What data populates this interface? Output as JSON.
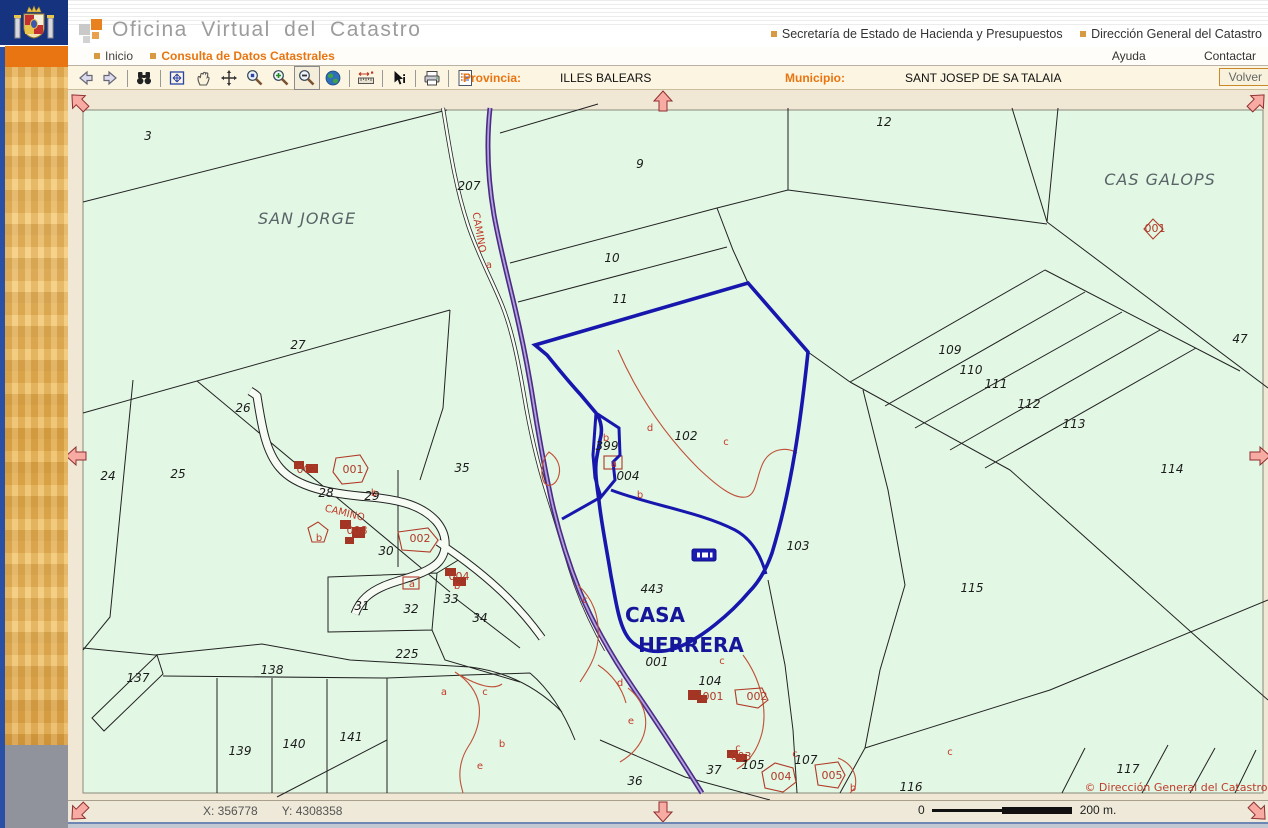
{
  "header": {
    "title": "Oficina Virtual del Catastro",
    "link1": "Secretaría de Estado de Hacienda y Presupuestos",
    "link2": "Dirección General del Catastro"
  },
  "menu": {
    "inicio": "Inicio",
    "consulta": "Consulta de Datos Catastrales",
    "ayuda": "Ayuda",
    "contactar": "Contactar"
  },
  "toolbar": {
    "tools": [
      "back",
      "forward",
      "find",
      "full-extent",
      "pan",
      "move",
      "zoom-rect",
      "zoom-in",
      "zoom-out",
      "world",
      "measure",
      "info",
      "print",
      "report"
    ],
    "active_tool": "zoom-out",
    "provincia_label": "Provincia:",
    "provincia_value": "ILLES BALEARS",
    "municipio_label": "Municipio:",
    "municipio_value": "SANT JOSEP DE SA TALAIA",
    "volver": "Volver"
  },
  "statusbar": {
    "x_coord": "X: 356778",
    "y_coord": "Y: 4308358",
    "scale_zero": "0",
    "scale_end": "200 m."
  },
  "map": {
    "copyright": "© Dirección General del Catastro",
    "colors": {
      "accent_orange": "#E87511",
      "map_green": "#E2F7E4",
      "selection_blue": "#1717AE",
      "building_red": "#B03A28",
      "arrow_pink": "#F7ABA3"
    },
    "labels": [
      {
        "t": "3",
        "x": 148,
        "y": 140,
        "c": "pn"
      },
      {
        "t": "9",
        "x": 640,
        "y": 168,
        "c": "pn"
      },
      {
        "t": "10",
        "x": 612,
        "y": 262,
        "c": "pn"
      },
      {
        "t": "11",
        "x": 620,
        "y": 303,
        "c": "pn"
      },
      {
        "t": "12",
        "x": 884,
        "y": 126,
        "c": "pn"
      },
      {
        "t": "207",
        "x": 469,
        "y": 190,
        "c": "pn"
      },
      {
        "t": "27",
        "x": 298,
        "y": 349,
        "c": "pn"
      },
      {
        "t": "26",
        "x": 243,
        "y": 412,
        "c": "pn"
      },
      {
        "t": "24",
        "x": 108,
        "y": 480,
        "c": "pn"
      },
      {
        "t": "25",
        "x": 178,
        "y": 478,
        "c": "pn"
      },
      {
        "t": "35",
        "x": 462,
        "y": 472,
        "c": "pn"
      },
      {
        "t": "28",
        "x": 326,
        "y": 497,
        "c": "pn"
      },
      {
        "t": "29",
        "x": 372,
        "y": 500,
        "c": "pn"
      },
      {
        "t": "30",
        "x": 386,
        "y": 555,
        "c": "pn"
      },
      {
        "t": "31",
        "x": 362,
        "y": 610,
        "c": "pn"
      },
      {
        "t": "32",
        "x": 411,
        "y": 613,
        "c": "pn"
      },
      {
        "t": "33",
        "x": 451,
        "y": 603,
        "c": "pn"
      },
      {
        "t": "34",
        "x": 480,
        "y": 622,
        "c": "pn"
      },
      {
        "t": "36",
        "x": 635,
        "y": 785,
        "c": "pn"
      },
      {
        "t": "37",
        "x": 714,
        "y": 774,
        "c": "pn"
      },
      {
        "t": "47",
        "x": 1240,
        "y": 343,
        "c": "pn"
      },
      {
        "t": "102",
        "x": 686,
        "y": 440,
        "c": "pn"
      },
      {
        "t": "103",
        "x": 798,
        "y": 550,
        "c": "pn"
      },
      {
        "t": "104",
        "x": 710,
        "y": 685,
        "c": "pn"
      },
      {
        "t": "105",
        "x": 753,
        "y": 769,
        "c": "pn"
      },
      {
        "t": "107",
        "x": 806,
        "y": 764,
        "c": "pn"
      },
      {
        "t": "109",
        "x": 950,
        "y": 354,
        "c": "pn"
      },
      {
        "t": "110",
        "x": 971,
        "y": 374,
        "c": "pn"
      },
      {
        "t": "111",
        "x": 996,
        "y": 388,
        "c": "pn"
      },
      {
        "t": "112",
        "x": 1029,
        "y": 408,
        "c": "pn"
      },
      {
        "t": "113",
        "x": 1074,
        "y": 428,
        "c": "pn"
      },
      {
        "t": "114",
        "x": 1172,
        "y": 473,
        "c": "pn"
      },
      {
        "t": "115",
        "x": 972,
        "y": 592,
        "c": "pn"
      },
      {
        "t": "116",
        "x": 911,
        "y": 791,
        "c": "pn"
      },
      {
        "t": "117",
        "x": 1128,
        "y": 773,
        "c": "pn"
      },
      {
        "t": "137",
        "x": 138,
        "y": 682,
        "c": "pn"
      },
      {
        "t": "138",
        "x": 272,
        "y": 674,
        "c": "pn"
      },
      {
        "t": "139",
        "x": 240,
        "y": 755,
        "c": "pn"
      },
      {
        "t": "140",
        "x": 294,
        "y": 748,
        "c": "pn"
      },
      {
        "t": "141",
        "x": 351,
        "y": 741,
        "c": "pn"
      },
      {
        "t": "225",
        "x": 407,
        "y": 658,
        "c": "pn"
      },
      {
        "t": "443",
        "x": 652,
        "y": 593,
        "c": "pn"
      },
      {
        "t": "399",
        "x": 607,
        "y": 450,
        "c": "pn"
      },
      {
        "t": "004",
        "x": 628,
        "y": 480,
        "c": "pn"
      },
      {
        "t": "001",
        "x": 657,
        "y": 666,
        "c": "pn"
      },
      {
        "t": "SAN JORGE",
        "x": 307,
        "y": 224,
        "c": "place"
      },
      {
        "t": "CAS GALOPS",
        "x": 1160,
        "y": 185,
        "c": "place"
      },
      {
        "t": "CASA",
        "x": 655,
        "y": 622,
        "c": "casa"
      },
      {
        "t": "HERRERA",
        "x": 691,
        "y": 652,
        "c": "casa"
      },
      {
        "t": "CAMINO",
        "x": 476,
        "y": 233,
        "c": "red",
        "r": 80
      },
      {
        "t": "CAMINO",
        "x": 344,
        "y": 516,
        "c": "red",
        "r": 14
      },
      {
        "t": "002",
        "x": 307,
        "y": 473,
        "c": "redb"
      },
      {
        "t": "001",
        "x": 353,
        "y": 473,
        "c": "redb"
      },
      {
        "t": "008",
        "x": 357,
        "y": 534,
        "c": "redb"
      },
      {
        "t": "002",
        "x": 420,
        "y": 542,
        "c": "redb"
      },
      {
        "t": "004",
        "x": 459,
        "y": 580,
        "c": "redb"
      },
      {
        "t": "001",
        "x": 1155,
        "y": 232,
        "c": "redb"
      },
      {
        "t": "001",
        "x": 713,
        "y": 700,
        "c": "redb"
      },
      {
        "t": "002",
        "x": 757,
        "y": 700,
        "c": "redb"
      },
      {
        "t": "003",
        "x": 741,
        "y": 760,
        "c": "redb"
      },
      {
        "t": "004",
        "x": 781,
        "y": 780,
        "c": "redb"
      },
      {
        "t": "005",
        "x": 832,
        "y": 779,
        "c": "redb"
      },
      {
        "t": "a",
        "x": 489,
        "y": 268,
        "c": "red"
      },
      {
        "t": "b",
        "x": 606,
        "y": 441,
        "c": "red"
      },
      {
        "t": "a",
        "x": 614,
        "y": 467,
        "c": "red"
      },
      {
        "t": "b",
        "x": 640,
        "y": 498,
        "c": "red"
      },
      {
        "t": "d",
        "x": 650,
        "y": 431,
        "c": "red"
      },
      {
        "t": "c",
        "x": 726,
        "y": 445,
        "c": "red"
      },
      {
        "t": "c",
        "x": 585,
        "y": 603,
        "c": "red"
      },
      {
        "t": "d",
        "x": 620,
        "y": 686,
        "c": "red"
      },
      {
        "t": "e",
        "x": 631,
        "y": 724,
        "c": "red"
      },
      {
        "t": "c",
        "x": 722,
        "y": 664,
        "c": "red"
      },
      {
        "t": "c",
        "x": 738,
        "y": 751,
        "c": "red"
      },
      {
        "t": "c",
        "x": 795,
        "y": 757,
        "c": "red"
      },
      {
        "t": "c",
        "x": 950,
        "y": 755,
        "c": "red"
      },
      {
        "t": "b",
        "x": 853,
        "y": 791,
        "c": "red"
      },
      {
        "t": "a",
        "x": 444,
        "y": 695,
        "c": "red"
      },
      {
        "t": "c",
        "x": 485,
        "y": 695,
        "c": "red"
      },
      {
        "t": "b",
        "x": 502,
        "y": 747,
        "c": "red"
      },
      {
        "t": "e",
        "x": 480,
        "y": 769,
        "c": "red"
      },
      {
        "t": "b",
        "x": 374,
        "y": 496,
        "c": "red"
      },
      {
        "t": "b",
        "x": 457,
        "y": 589,
        "c": "red"
      },
      {
        "t": "a",
        "x": 412,
        "y": 587,
        "c": "red"
      },
      {
        "t": "b",
        "x": 319,
        "y": 541,
        "c": "red"
      },
      {
        "t": "© Dirección General del Catastro",
        "x": 1176,
        "y": 791,
        "c": "copy"
      }
    ]
  }
}
